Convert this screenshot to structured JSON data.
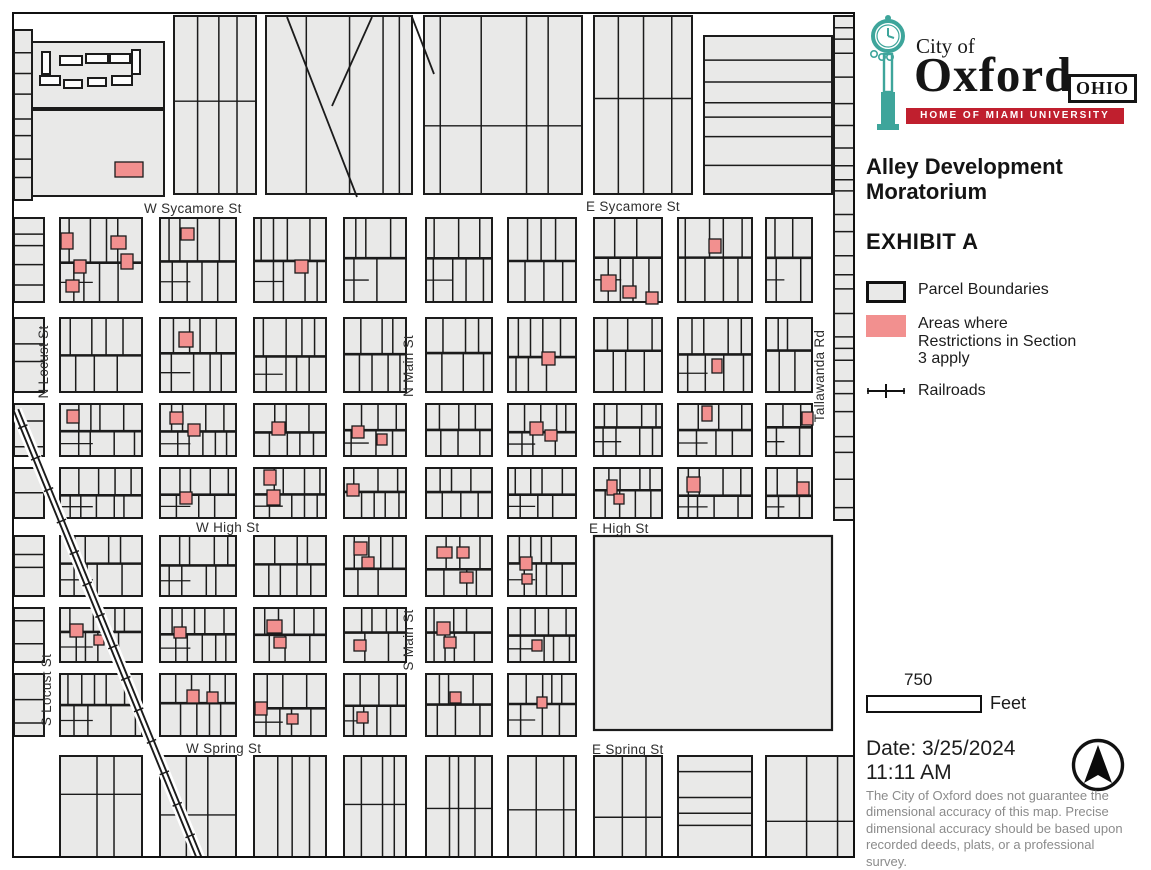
{
  "logo": {
    "city_of": "City of",
    "name": "Oxford",
    "state": "OHIO",
    "tagline": "HOME OF MIAMI UNIVERSITY",
    "banner_color": "#C01F2E",
    "clock_color": "#3EA59B"
  },
  "title": "Alley Development Moratorium",
  "exhibit": "EXHIBIT A",
  "legend": {
    "items": [
      {
        "label": "Parcel Boundaries",
        "swatch": "parcel",
        "fill": "#e9e9e8"
      },
      {
        "label": "Areas where Restrictions in Section 3 apply",
        "swatch": "restricted",
        "fill": "#F2908F"
      },
      {
        "label": "Railroads",
        "swatch": "railroad"
      }
    ]
  },
  "scale_bar": {
    "value": "750",
    "unit": "Feet"
  },
  "date_stamp": {
    "date": "Date: 3/25/2024",
    "time": "11:11 AM"
  },
  "disclaimer": "The City of Oxford does not guarantee the dimensional accuracy of this map. Precise dimensional accuracy should be based upon recorded deeds, plats, or a professional survey.",
  "map": {
    "colors": {
      "parcel": "#e9e9e8",
      "stroke": "#1b1b1b",
      "restricted": "#F2908F",
      "street": "#ffffff"
    },
    "street_labels": [
      {
        "text": "W Sycamore St",
        "x": 130,
        "y": 199
      },
      {
        "text": "E Sycamore St",
        "x": 572,
        "y": 197
      },
      {
        "text": "W High St",
        "x": 182,
        "y": 518
      },
      {
        "text": "E High St",
        "x": 575,
        "y": 519
      },
      {
        "text": "W Spring St",
        "x": 172,
        "y": 739
      },
      {
        "text": "E Spring St",
        "x": 578,
        "y": 740
      },
      {
        "text": "N Locust St",
        "x": 34,
        "y": 348,
        "rotate": -90
      },
      {
        "text": "N Main St",
        "x": 399,
        "y": 352,
        "rotate": -90
      },
      {
        "text": "S Locust St",
        "x": 37,
        "y": 676,
        "rotate": -90
      },
      {
        "text": "S Main St",
        "x": 399,
        "y": 626,
        "rotate": -90
      },
      {
        "text": "Tallawanda Rd",
        "x": 810,
        "y": 362,
        "rotate": -90
      }
    ],
    "grid": {
      "cols": [
        [
          46,
          82
        ],
        [
          146,
          76
        ],
        [
          240,
          72
        ],
        [
          330,
          62
        ],
        [
          412,
          66
        ],
        [
          494,
          68
        ],
        [
          580,
          68
        ],
        [
          664,
          74
        ],
        [
          752,
          46
        ]
      ],
      "rows": [
        [
          204,
          84
        ],
        [
          304,
          74
        ],
        [
          390,
          52
        ],
        [
          454,
          50
        ],
        [
          522,
          60
        ],
        [
          594,
          54
        ],
        [
          660,
          62
        ]
      ],
      "park_skip": {
        "row_from": 4,
        "col_from": 6
      }
    },
    "park": [
      580,
      522,
      238,
      194
    ],
    "extra_blocks": [
      {
        "r": [
          18,
          28,
          132,
          66
        ],
        "mode": "plain",
        "seed": 1
      },
      {
        "r": [
          18,
          96,
          132,
          86
        ],
        "mode": "plain",
        "seed": 2
      },
      {
        "r": [
          160,
          2,
          82,
          178
        ],
        "mode": "v1",
        "seed": 11
      },
      {
        "r": [
          252,
          2,
          146,
          178
        ],
        "mode": "v1s",
        "seed": 12
      },
      {
        "r": [
          410,
          2,
          158,
          178
        ],
        "mode": "v1s",
        "seed": 13
      },
      {
        "r": [
          580,
          2,
          98,
          178
        ],
        "mode": "v1s",
        "seed": 14
      },
      {
        "r": [
          690,
          22,
          128,
          158
        ],
        "mode": "h",
        "seed": 15
      },
      {
        "r": [
          820,
          2,
          23,
          504
        ],
        "mode": "h",
        "seed": 16
      },
      {
        "r": [
          0,
          16,
          18,
          170
        ],
        "mode": "h",
        "seed": 20
      },
      {
        "r": [
          0,
          204,
          30,
          84
        ],
        "mode": "h",
        "seed": 21
      },
      {
        "r": [
          0,
          304,
          30,
          74
        ],
        "mode": "h",
        "seed": 22
      },
      {
        "r": [
          0,
          390,
          30,
          52
        ],
        "mode": "h",
        "seed": 23
      },
      {
        "r": [
          0,
          454,
          30,
          50
        ],
        "mode": "h",
        "seed": 24
      },
      {
        "r": [
          0,
          522,
          30,
          60
        ],
        "mode": "h",
        "seed": 25
      },
      {
        "r": [
          0,
          594,
          30,
          54
        ],
        "mode": "h",
        "seed": 26
      },
      {
        "r": [
          0,
          660,
          30,
          62
        ],
        "mode": "h",
        "seed": 27
      },
      {
        "r": [
          46,
          742,
          82,
          102
        ],
        "mode": "v1s",
        "seed": 31
      },
      {
        "r": [
          146,
          742,
          76,
          102
        ],
        "mode": "v1s",
        "seed": 32
      },
      {
        "r": [
          240,
          742,
          72,
          102
        ],
        "mode": "v1",
        "seed": 33
      },
      {
        "r": [
          330,
          742,
          62,
          102
        ],
        "mode": "v1",
        "seed": 34
      },
      {
        "r": [
          412,
          742,
          66,
          102
        ],
        "mode": "v1",
        "seed": 35
      },
      {
        "r": [
          494,
          742,
          68,
          102
        ],
        "mode": "v1s",
        "seed": 36
      },
      {
        "r": [
          580,
          742,
          68,
          102
        ],
        "mode": "v1s",
        "seed": 37
      },
      {
        "r": [
          664,
          742,
          74,
          102
        ],
        "mode": "h",
        "seed": 38
      },
      {
        "r": [
          752,
          742,
          91,
          102
        ],
        "mode": "v1s",
        "seed": 39
      }
    ],
    "buildings": [
      [
        28,
        38,
        8,
        22
      ],
      [
        46,
        42,
        22,
        9
      ],
      [
        72,
        40,
        22,
        9
      ],
      [
        96,
        40,
        20,
        9
      ],
      [
        118,
        36,
        8,
        24
      ],
      [
        26,
        62,
        20,
        9
      ],
      [
        50,
        66,
        18,
        8
      ],
      [
        74,
        64,
        18,
        8
      ],
      [
        98,
        62,
        20,
        9
      ]
    ],
    "diagonals": [
      [
        273,
        3,
        343,
        183
      ],
      [
        358,
        3,
        318,
        92
      ],
      [
        398,
        3,
        420,
        60
      ]
    ],
    "railroad": {
      "x1": 2,
      "y1": 396,
      "x2": 186,
      "y2": 846
    },
    "restricted_parcels": [
      [
        101,
        148,
        28,
        15
      ],
      [
        47,
        219,
        12,
        16
      ],
      [
        60,
        246,
        12,
        13
      ],
      [
        52,
        266,
        13,
        12
      ],
      [
        97,
        222,
        15,
        13
      ],
      [
        107,
        240,
        12,
        15
      ],
      [
        167,
        214,
        13,
        12
      ],
      [
        281,
        246,
        13,
        13
      ],
      [
        587,
        261,
        15,
        16
      ],
      [
        609,
        272,
        13,
        12
      ],
      [
        632,
        278,
        12,
        12
      ],
      [
        695,
        225,
        12,
        14
      ],
      [
        165,
        318,
        14,
        15
      ],
      [
        528,
        338,
        13,
        13
      ],
      [
        698,
        345,
        10,
        14
      ],
      [
        53,
        396,
        12,
        13
      ],
      [
        156,
        398,
        13,
        12
      ],
      [
        174,
        410,
        12,
        12
      ],
      [
        258,
        408,
        13,
        13
      ],
      [
        338,
        412,
        12,
        12
      ],
      [
        363,
        420,
        10,
        11
      ],
      [
        516,
        408,
        13,
        13
      ],
      [
        531,
        416,
        12,
        11
      ],
      [
        688,
        392,
        10,
        15
      ],
      [
        788,
        398,
        11,
        13
      ],
      [
        250,
        456,
        12,
        15
      ],
      [
        253,
        476,
        13,
        15
      ],
      [
        166,
        478,
        12,
        12
      ],
      [
        333,
        470,
        12,
        12
      ],
      [
        593,
        466,
        10,
        15
      ],
      [
        600,
        480,
        10,
        10
      ],
      [
        673,
        463,
        13,
        15
      ],
      [
        783,
        468,
        12,
        13
      ],
      [
        340,
        528,
        13,
        13
      ],
      [
        348,
        543,
        12,
        11
      ],
      [
        423,
        533,
        15,
        11
      ],
      [
        443,
        533,
        12,
        11
      ],
      [
        446,
        558,
        13,
        11
      ],
      [
        506,
        543,
        12,
        13
      ],
      [
        508,
        560,
        10,
        10
      ],
      [
        56,
        610,
        13,
        13
      ],
      [
        160,
        613,
        12,
        11
      ],
      [
        253,
        606,
        15,
        13
      ],
      [
        260,
        623,
        12,
        11
      ],
      [
        340,
        626,
        12,
        11
      ],
      [
        423,
        608,
        13,
        13
      ],
      [
        430,
        623,
        12,
        11
      ],
      [
        518,
        626,
        10,
        11
      ],
      [
        80,
        621,
        10,
        10
      ],
      [
        173,
        676,
        12,
        13
      ],
      [
        193,
        678,
        11,
        11
      ],
      [
        241,
        688,
        12,
        13
      ],
      [
        273,
        700,
        11,
        10
      ],
      [
        343,
        698,
        11,
        11
      ],
      [
        436,
        678,
        11,
        11
      ],
      [
        523,
        683,
        10,
        11
      ]
    ]
  }
}
